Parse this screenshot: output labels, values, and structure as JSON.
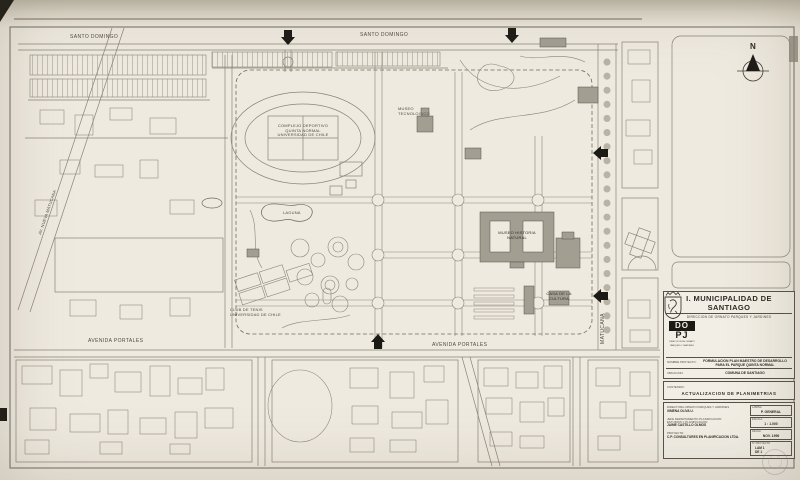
{
  "colors": {
    "paper": "#efeae0",
    "linework": "#8a8476",
    "ink": "#3f3b34",
    "building_shade": "#a39e92",
    "black_accent": "#1c1a15",
    "stamp": "#8c78a0"
  },
  "north_label": "N",
  "streets": {
    "santo_domingo": "SANTO DOMINGO",
    "avenida_portales": "AVENIDA PORTALES",
    "matucana": "MATUCANA",
    "nueva_matucana": "AV. NUEVA MATUCANA"
  },
  "park_labels": {
    "sports_complex_1": "COMPLEJO DEPORTIVO",
    "sports_complex_2": "QUINTA NORMAL",
    "sports_complex_3": "UNIVERSIDAD DE CHILE",
    "lagoon": "LAGUNA",
    "museum_1": "MUSEO HISTORIA",
    "museum_2": "NATURAL",
    "tennis_1": "CLUB DE TENIS",
    "tennis_2": "UNIVERSIDAD DE CHILE",
    "tech_museum_1": "MUSEO",
    "tech_museum_2": "TECNOLOGICO",
    "culture_house_1": "CASA DE LA",
    "culture_house_2": "CULTURA"
  },
  "title_block": {
    "title": "I. MUNICIPALIDAD DE SANTIAGO",
    "subtitle": "DIRECCION DE ORNATO PARQUES Y JARDINES",
    "logo": {
      "top": "DO",
      "bottom": "PJ",
      "caption_1": "DIRECCION DE ORNATO",
      "caption_2": "PARQUES Y JARDINES"
    },
    "fields": {
      "project_label": "NOMBRE PROYECTO:",
      "project_value_1": "FORMULACION PLAN MAESTRO DE DESARROLLO",
      "project_value_2": "PARA EL PARQUE QUINTA NORMAL",
      "location_label": "UBICACION:",
      "location_value": "COMUNA DE SANTIAGO",
      "content_label": "CONTENIDO:",
      "content_value": "ACTUALIZACION DE PLANIMETRIAS"
    },
    "signatures": {
      "director_label": "DIRECTORA ORNATO PARQUES Y JARDINES",
      "director_name": "XIMENA OLIVA U.",
      "chief_label_1": "JEFE DEPARTAMENTO PLANIFICACION",
      "chief_label_2": "ESTUDIOS Y PLANIFICACION",
      "chief_name": "JAIME CASTILLO OLMOS",
      "author_label": "PROYECTO:",
      "author_name": "C.P. CONSULTORES EN PLANIFICACION LTDA."
    },
    "meta": {
      "sheet_label": "LAMINA",
      "sheet_value": "P. GENERAL",
      "scale_label": "ESCALA",
      "scale_value": "1 : 1.000",
      "date_label": "FECHA",
      "date_value": "NOV. 1996",
      "project_no_label": "N° PROYECTO",
      "project_no_value_1": "LAM 1",
      "project_no_value_2": "DE 1"
    }
  }
}
